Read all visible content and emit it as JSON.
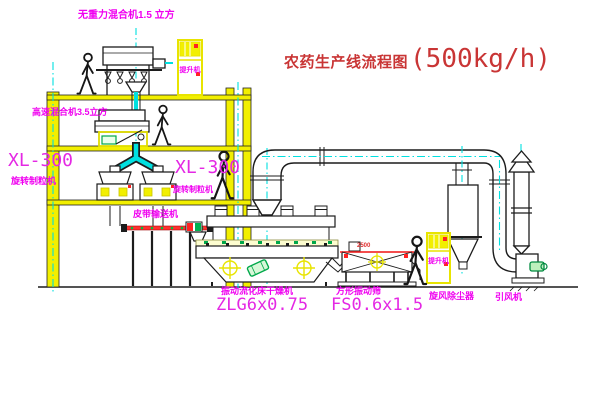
{
  "title": {
    "text": "农药生产线流程图",
    "capacity": "(500kg/h)"
  },
  "equipment": {
    "gravity_mixer": {
      "label": "无重力混合机1.5 立方"
    },
    "high_speed_mixer": {
      "label": "高速混合机3.5立方"
    },
    "granulator_left": {
      "model": "XL-300",
      "name": "旋转制粒机"
    },
    "granulator_right": {
      "model": "XL-300",
      "name": "旋转制粒机"
    },
    "belt_conveyor": {
      "name": "皮带输送机"
    },
    "fluid_bed_dryer": {
      "name": "振动流化床干燥机",
      "model": "ZLG6x0.75"
    },
    "square_sieve": {
      "name": "方形振动筛",
      "model": "FS0.6x1.5",
      "dimension": "2500"
    },
    "cyclone": {
      "name": "旋风除尘器"
    },
    "fan": {
      "name": "引风机"
    },
    "hoist_top": {
      "label": "提升机"
    },
    "hoist_right": {
      "label": "提升机"
    }
  },
  "colors": {
    "label_magenta": "#f000f0",
    "title_red": "#c93535",
    "line_black": "#1c1c1c",
    "structure_yellow": "#f2ef00",
    "pipe_cyan": "#00e0e0",
    "accent_green": "#00a84a",
    "accent_red": "#ff2222"
  }
}
